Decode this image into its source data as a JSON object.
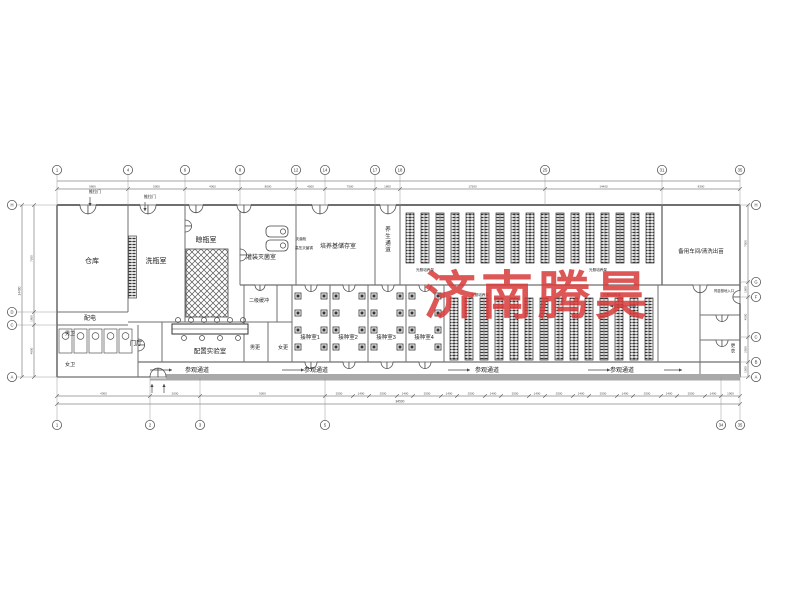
{
  "watermark": {
    "text": "济南腾昊",
    "color": "#d93a3a"
  },
  "plan": {
    "colors": {
      "wall": "#6f6f6f",
      "thin": "#555555",
      "dim": "#4a4a4a",
      "band": "#a9a9a9",
      "rack": "#333333"
    },
    "rooms": [
      {
        "label": "仓库",
        "x": 92,
        "y": 263,
        "s": 7
      },
      {
        "label": "洗瓶室",
        "x": 156,
        "y": 263,
        "s": 7
      },
      {
        "label": "晾瓶室",
        "x": 206,
        "y": 242,
        "s": 7
      },
      {
        "label": "灌装灭菌室",
        "x": 261,
        "y": 259,
        "s": 6
      },
      {
        "label": "培养基储存室",
        "x": 338,
        "y": 248,
        "s": 6
      },
      {
        "label": "养生通道",
        "x": 388,
        "y": 231,
        "s": 5.5,
        "v": true
      },
      {
        "label": "备用车间/清洗出苗",
        "x": 701,
        "y": 253,
        "s": 5.5
      },
      {
        "label": "配电",
        "x": 90,
        "y": 320,
        "s": 6
      },
      {
        "label": "男卫",
        "x": 70,
        "y": 335,
        "s": 5
      },
      {
        "label": "女卫",
        "x": 70,
        "y": 366,
        "s": 5
      },
      {
        "label": "门厅",
        "x": 136,
        "y": 345,
        "s": 6.5
      },
      {
        "label": "配置实验室",
        "x": 210,
        "y": 353,
        "s": 6.5
      },
      {
        "label": "二级缓冲",
        "x": 259,
        "y": 302,
        "s": 5
      },
      {
        "label": "男更",
        "x": 255,
        "y": 349,
        "s": 5
      },
      {
        "label": "女更",
        "x": 283,
        "y": 349,
        "s": 5
      },
      {
        "label": "接种室1",
        "x": 310,
        "y": 339,
        "s": 5.5
      },
      {
        "label": "接种室2",
        "x": 348,
        "y": 339,
        "s": 5.5
      },
      {
        "label": "接种室3",
        "x": 386,
        "y": 339,
        "s": 5.5
      },
      {
        "label": "接种室4",
        "x": 424,
        "y": 339,
        "s": 5.5
      },
      {
        "label": "参观通道",
        "x": 197,
        "y": 372,
        "s": 6
      },
      {
        "label": "参观通道",
        "x": 316,
        "y": 372,
        "s": 6
      },
      {
        "label": "参观通道",
        "x": 487,
        "y": 372,
        "s": 6
      },
      {
        "label": "参观通道",
        "x": 622,
        "y": 372,
        "s": 6
      },
      {
        "label": "光照培养架",
        "x": 425,
        "y": 271,
        "s": 3.6
      },
      {
        "label": "光照培养架",
        "x": 598,
        "y": 271,
        "s": 3.6
      },
      {
        "label": "光照培养架",
        "x": 480,
        "y": 296,
        "s": 3.6
      },
      {
        "label": "光照培养架",
        "x": 612,
        "y": 296,
        "s": 3.6
      },
      {
        "label": "推拉门",
        "x": 95,
        "y": 193,
        "s": 4
      },
      {
        "label": "推拉门",
        "x": 150,
        "y": 198,
        "s": 4
      },
      {
        "label": "灭菌柜",
        "x": 301,
        "y": 240,
        "s": 3.6
      },
      {
        "label": "高压灭菌锅",
        "x": 304,
        "y": 249,
        "s": 3.6
      },
      {
        "label": "育苗基地入口",
        "x": 724,
        "y": 292,
        "s": 3.4
      },
      {
        "label": "更衣",
        "x": 733,
        "y": 347,
        "s": 4.5,
        "v": true
      }
    ],
    "walls": [
      [
        57,
        205,
        740,
        205,
        2
      ],
      [
        57,
        205,
        57,
        377,
        1.6
      ],
      [
        740,
        205,
        740,
        377,
        1.6
      ],
      [
        57,
        377,
        740,
        377,
        1.2
      ],
      [
        128,
        205,
        128,
        312,
        1
      ],
      [
        185,
        205,
        185,
        322,
        1
      ],
      [
        240,
        205,
        240,
        285,
        1
      ],
      [
        296,
        205,
        296,
        285,
        1
      ],
      [
        375,
        205,
        375,
        285,
        1
      ],
      [
        400,
        205,
        400,
        285,
        1
      ],
      [
        662,
        205,
        662,
        285,
        1.4
      ],
      [
        240,
        285,
        740,
        285,
        1.2
      ],
      [
        128,
        322,
        292,
        322,
        1
      ],
      [
        57,
        312,
        128,
        312,
        1
      ],
      [
        57,
        325,
        128,
        325,
        1
      ],
      [
        138,
        325,
        138,
        377,
        1
      ],
      [
        162,
        322,
        162,
        362,
        1
      ],
      [
        244,
        285,
        244,
        362,
        1
      ],
      [
        277,
        285,
        277,
        322,
        1
      ],
      [
        268,
        322,
        268,
        362,
        1
      ],
      [
        292,
        285,
        292,
        362,
        1
      ],
      [
        330,
        285,
        330,
        362,
        1
      ],
      [
        368,
        285,
        368,
        362,
        1
      ],
      [
        406,
        285,
        406,
        362,
        1
      ],
      [
        444,
        285,
        444,
        362,
        1
      ],
      [
        658,
        285,
        658,
        362,
        1
      ],
      [
        700,
        285,
        700,
        377,
        1
      ],
      [
        700,
        315,
        740,
        315,
        1
      ],
      [
        700,
        340,
        740,
        340,
        1
      ],
      [
        138,
        362,
        740,
        362,
        1.2
      ]
    ],
    "doors": [
      {
        "x": 88,
        "y": 205,
        "d": "down",
        "w": 16
      },
      {
        "x": 148,
        "y": 205,
        "d": "down",
        "w": 16
      },
      {
        "x": 196,
        "y": 205,
        "d": "down",
        "w": 14
      },
      {
        "x": 244,
        "y": 205,
        "d": "down",
        "w": 14
      },
      {
        "x": 320,
        "y": 205,
        "d": "down",
        "w": 16
      },
      {
        "x": 388,
        "y": 205,
        "d": "down",
        "w": 16
      },
      {
        "x": 260,
        "y": 285,
        "d": "down",
        "w": 10
      },
      {
        "x": 311,
        "y": 285,
        "d": "down",
        "w": 12
      },
      {
        "x": 349,
        "y": 285,
        "d": "down",
        "w": 12
      },
      {
        "x": 388,
        "y": 285,
        "d": "down",
        "w": 12
      },
      {
        "x": 425,
        "y": 285,
        "d": "down",
        "w": 12
      },
      {
        "x": 700,
        "y": 285,
        "d": "down",
        "w": 14
      },
      {
        "x": 311,
        "y": 362,
        "d": "down",
        "w": 12
      },
      {
        "x": 349,
        "y": 362,
        "d": "down",
        "w": 12
      },
      {
        "x": 387,
        "y": 362,
        "d": "down",
        "w": 12
      },
      {
        "x": 425,
        "y": 362,
        "d": "down",
        "w": 12
      },
      {
        "x": 158,
        "y": 377,
        "d": "up",
        "w": 16
      },
      {
        "x": 740,
        "y": 297,
        "d": "left",
        "w": 13
      },
      {
        "x": 722,
        "y": 315,
        "d": "down",
        "w": 12
      },
      {
        "x": 722,
        "y": 340,
        "d": "down",
        "w": 12
      },
      {
        "x": 138,
        "y": 345,
        "d": "right",
        "w": 12
      },
      {
        "x": 185,
        "y": 226,
        "d": "right",
        "w": 12
      },
      {
        "x": 240,
        "y": 255,
        "d": "right",
        "w": 12
      }
    ],
    "rack_groups": [
      {
        "x": 406,
        "y": 213,
        "count": 17,
        "pitch": 15,
        "w": 8,
        "h": 50
      },
      {
        "x": 450,
        "y": 298,
        "count": 14,
        "pitch": 15,
        "w": 8,
        "h": 62
      }
    ],
    "hatch_block": {
      "x": 186,
      "y": 249,
      "w": 42,
      "h": 68
    },
    "ladder": {
      "x": 128.5,
      "y": 236,
      "w": 8,
      "h": 62
    },
    "autoclaves": [
      {
        "x": 266,
        "y": 226,
        "w": 22,
        "h": 11
      },
      {
        "x": 266,
        "y": 240,
        "w": 22,
        "h": 11
      }
    ],
    "lab_bench": {
      "x": 172,
      "y": 324,
      "w": 76,
      "h": 10,
      "stools_top": [
        178,
        191,
        204,
        217,
        230,
        243
      ],
      "stools_bottom": [
        184,
        202,
        220,
        238
      ]
    },
    "toilet": {
      "x": 59,
      "y": 329,
      "count": 5,
      "w": 13,
      "h": 24,
      "pitch": 15
    },
    "benches": {
      "cols": [
        295,
        321,
        333,
        359,
        371,
        397,
        409,
        435
      ],
      "y": 293,
      "count": 4,
      "step": 17,
      "size": 6
    },
    "arrows": [
      {
        "x": 150,
        "y": 370,
        "len": 22,
        "dir": "r"
      },
      {
        "x": 282,
        "y": 370,
        "len": 22,
        "dir": "r"
      },
      {
        "x": 448,
        "y": 370,
        "len": 22,
        "dir": "r"
      },
      {
        "x": 588,
        "y": 370,
        "len": 22,
        "dir": "r"
      },
      {
        "x": 664,
        "y": 370,
        "len": 18,
        "dir": "r"
      },
      {
        "x": 636,
        "y": 306,
        "len": 26,
        "dir": "l"
      },
      {
        "x": 152,
        "y": 393,
        "len": 9,
        "dir": "u"
      },
      {
        "x": 164,
        "y": 393,
        "len": 9,
        "dir": "u"
      },
      {
        "x": 90,
        "y": 197,
        "len": 9,
        "dir": "d"
      },
      {
        "x": 145,
        "y": 202,
        "len": 9,
        "dir": "d"
      }
    ],
    "band": {
      "x": 150,
      "y": 374,
      "w": 590,
      "h": 6.5
    },
    "grid": {
      "top": [
        [
          "1",
          57
        ],
        [
          "4",
          128
        ],
        [
          "6",
          185
        ],
        [
          "8",
          240
        ],
        [
          "12",
          296
        ],
        [
          "14",
          325
        ],
        [
          "17",
          375
        ],
        [
          "18",
          400
        ],
        [
          "25",
          545
        ],
        [
          "31",
          662
        ],
        [
          "35",
          740
        ]
      ],
      "bottom": [
        [
          "1",
          57
        ],
        [
          "2",
          150
        ],
        [
          "3",
          200
        ],
        [
          "5",
          325
        ],
        [
          "34",
          721
        ],
        [
          "35",
          740
        ]
      ],
      "left": [
        [
          "H",
          205
        ],
        [
          "D",
          312
        ],
        [
          "C",
          325
        ],
        [
          "A",
          377
        ]
      ],
      "right": [
        [
          "H",
          205
        ],
        [
          "G",
          282
        ],
        [
          "F",
          297
        ],
        [
          "C",
          337
        ],
        [
          "B",
          362
        ],
        [
          "A",
          377
        ]
      ]
    },
    "dims": {
      "top": {
        "ticks": [
          57,
          128,
          185,
          240,
          296,
          325,
          375,
          400,
          545,
          662,
          740
        ],
        "values": [
          "9800",
          "5000",
          "4000",
          "8000",
          "4500",
          "7500",
          "1800",
          "17500",
          "14400",
          "8300"
        ]
      },
      "bottom": {
        "ticks": [
          57,
          150,
          200,
          325,
          353,
          369,
          397,
          413,
          441,
          457,
          485,
          501,
          529,
          545,
          573,
          589,
          617,
          633,
          661,
          677,
          705,
          721,
          740
        ],
        "values": [
          "4300",
          "2000",
          "5000",
          "2500",
          "1400",
          "2500",
          "1400",
          "2500",
          "1400",
          "2500",
          "1400",
          "2500",
          "1400",
          "2500",
          "1400",
          "2500",
          "1400",
          "2500",
          "1400",
          "2500",
          "1400",
          "1900"
        ]
      },
      "overall_bottom": "84500",
      "left": {
        "ticks": [
          205,
          312,
          325,
          377
        ],
        "values": [
          "7200",
          "1800",
          "4800"
        ],
        "overall": "14400"
      },
      "right": {
        "ticks": [
          205,
          282,
          297,
          337,
          362,
          377
        ],
        "values": [
          "7500",
          "1800",
          "4000",
          "2500",
          "1500"
        ]
      }
    }
  }
}
